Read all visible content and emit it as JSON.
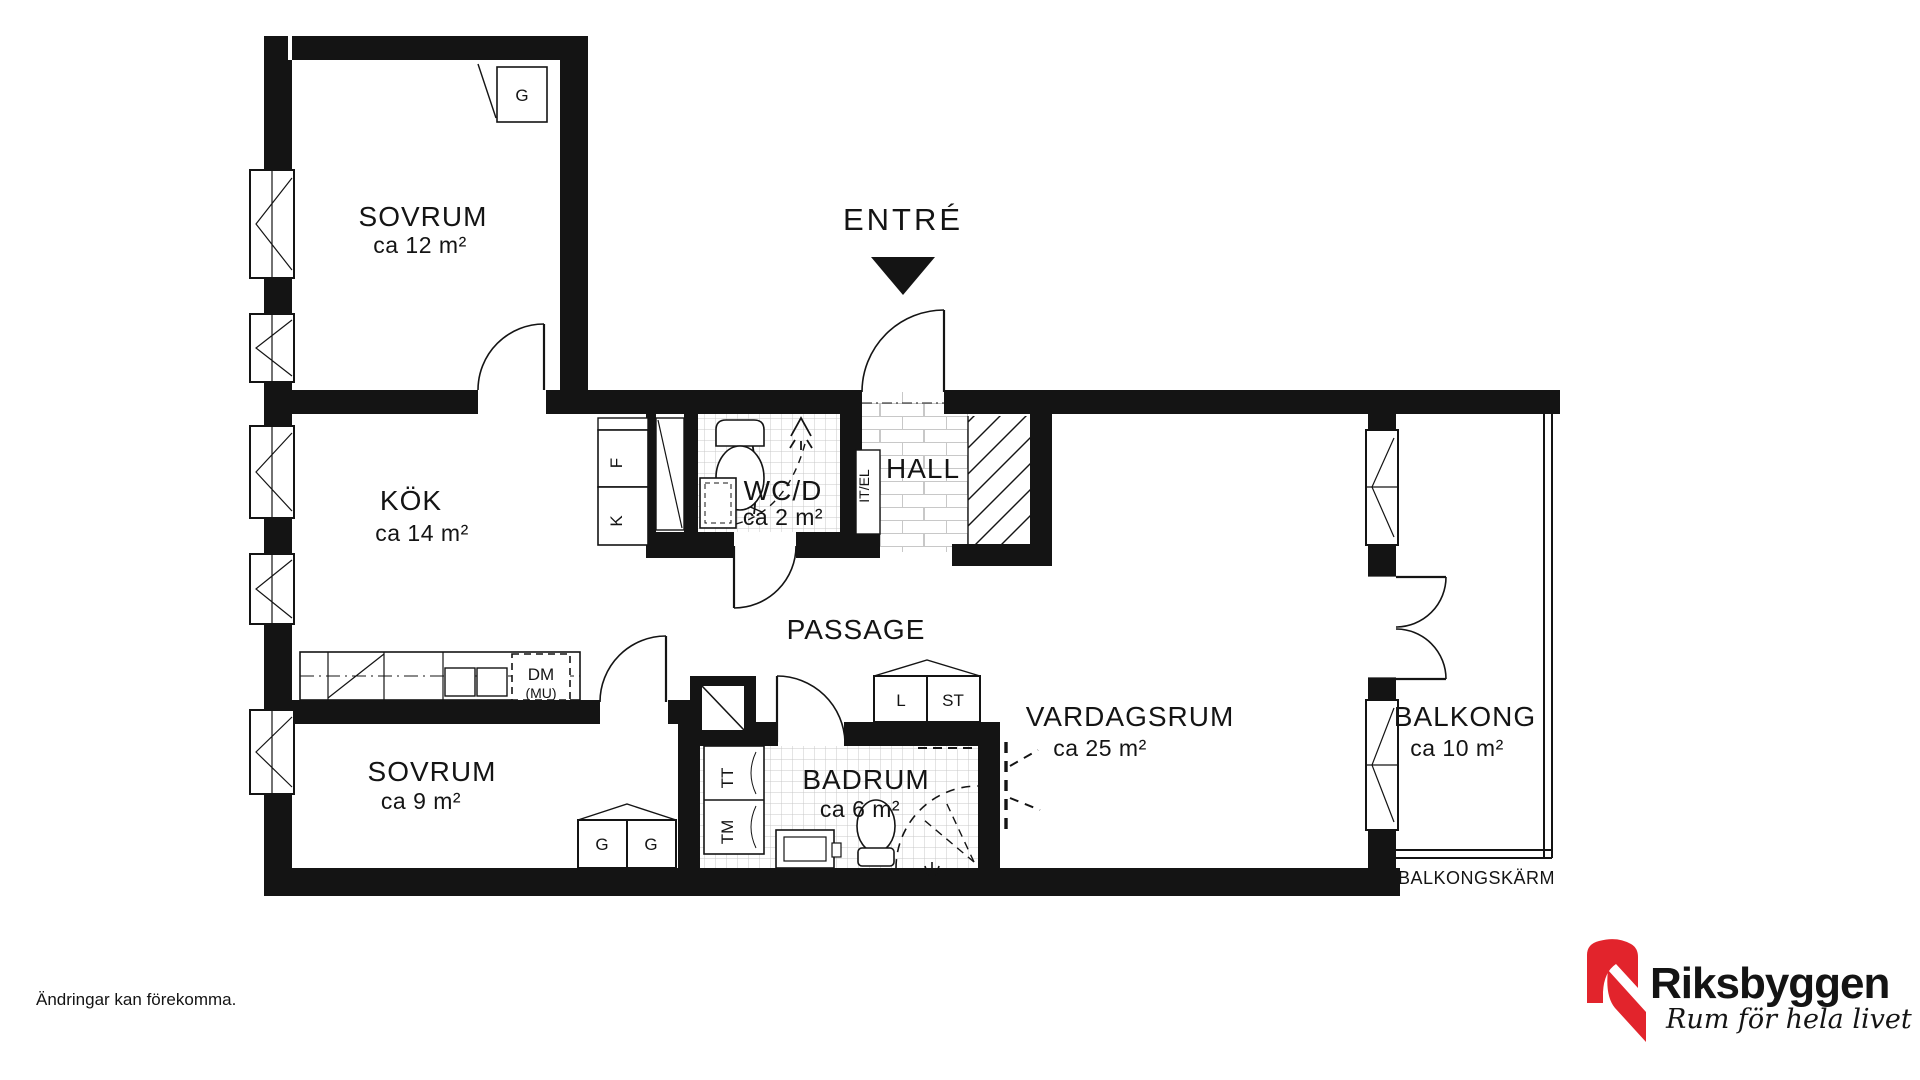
{
  "rooms": {
    "bedroom1": {
      "name": "SOVRUM",
      "area": "ca 12 m²"
    },
    "kitchen": {
      "name": "KÖK",
      "area": "ca 14 m²"
    },
    "wc": {
      "name": "WC/D",
      "area": "ca 2 m²"
    },
    "hall": {
      "name": "HALL"
    },
    "passage": {
      "name": "PASSAGE"
    },
    "bedroom2": {
      "name": "SOVRUM",
      "area": "ca 9 m²"
    },
    "bathroom": {
      "name": "BADRUM",
      "area": "ca 6 m²"
    },
    "livingroom": {
      "name": "VARDAGSRUM",
      "area": "ca 25 m²"
    },
    "balcony": {
      "name": "BALKONG",
      "area": "ca 10 m²"
    }
  },
  "labels": {
    "entrance": "ENTRÉ",
    "balcony_screen": "BALKONGSKÄRM",
    "wardrobe_g1": "G",
    "freezer": "F",
    "fridge": "K",
    "dishwasher": "DM",
    "dishwasher_note": "(MU)",
    "it_el": "IT/EL",
    "linen": "L",
    "cleaning": "ST",
    "dryer": "TT",
    "washer": "TM",
    "wardrobe_g2a": "G",
    "wardrobe_g2b": "G"
  },
  "footer": {
    "disclaimer": "Ändringar kan förekomma."
  },
  "brand": {
    "name": "Riksbyggen",
    "tagline": "Rum för hela livet",
    "logo_red": "#E2242C",
    "text_gray": "#9B9B9D",
    "ink": "#141414",
    "tile_line": "#c8c8c8"
  }
}
